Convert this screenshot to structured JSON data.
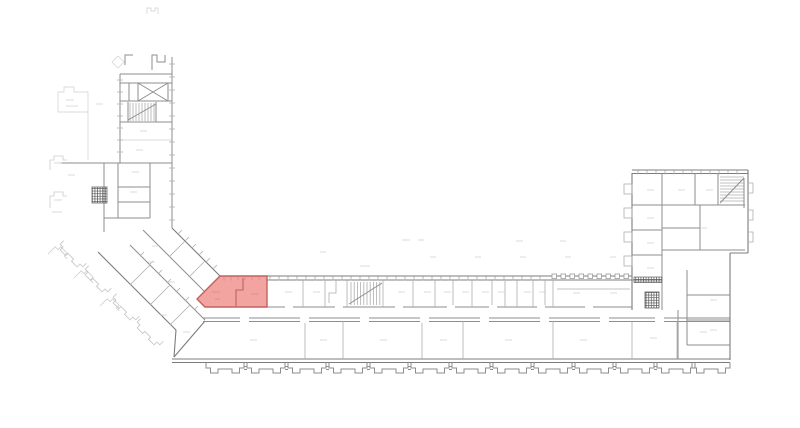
{
  "meta": {
    "title": "Building floor plan with highlighted room",
    "type": "architectural-floor-plan",
    "visible_text": ""
  },
  "canvas": {
    "width": 800,
    "height": 428,
    "background": "#ffffff"
  },
  "colors": {
    "wall": "#8e8e8e",
    "wall_strong": "#7c7c7c",
    "light_detail": "#aeaeae",
    "faint_detail": "#cfcfcf",
    "hatch": "#565656",
    "highlight_fill": "#f2a4a1",
    "highlight_stroke": "#c2615f",
    "highlight_inner": "#c06260",
    "highlight_tick": "#d98a88"
  },
  "highlighted_room": {
    "name": "selected-room",
    "shape": "pentagon",
    "location": "junction of diagonal wing and main south wing",
    "fill": "#f2a4a1",
    "stroke": "#c2615f",
    "inner_wall": "#c06260",
    "tick": "#d98a88"
  },
  "features": [
    {
      "name": "top-left-stair-tower",
      "kind": "wing"
    },
    {
      "name": "cross-braced-shaft",
      "kind": "shaft"
    },
    {
      "name": "staircase-top-left",
      "kind": "stair"
    },
    {
      "name": "elevator-shaft-left",
      "kind": "elevator"
    },
    {
      "name": "diagonal-wing",
      "kind": "wing"
    },
    {
      "name": "main-wing",
      "kind": "wing"
    },
    {
      "name": "central-staircase",
      "kind": "stair"
    },
    {
      "name": "bay-windows-south",
      "kind": "facade"
    },
    {
      "name": "right-wing",
      "kind": "wing"
    },
    {
      "name": "staircase-right-wing",
      "kind": "stair"
    },
    {
      "name": "elevator-shaft-right",
      "kind": "elevator"
    },
    {
      "name": "selected-room",
      "kind": "highlight"
    }
  ]
}
